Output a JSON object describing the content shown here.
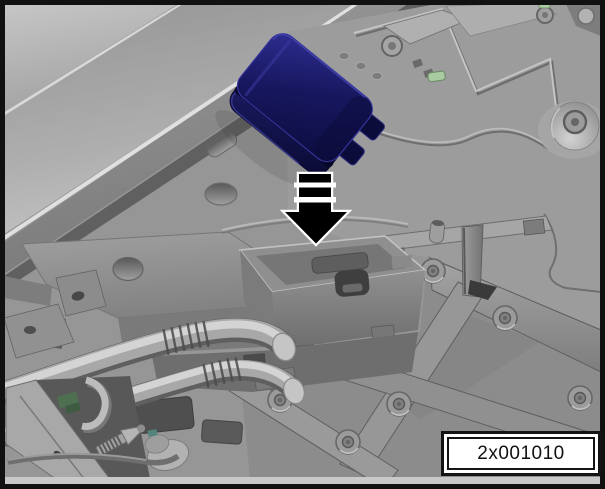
{
  "figure": {
    "type": "technical-illustration",
    "image_code": "2x001010",
    "arrow_direction": "down"
  },
  "label_box": {
    "text": "2x001010"
  },
  "colors": {
    "frame_border": "#111111",
    "background_gray": "#969696",
    "module_navy": "#16165e",
    "module_navy_light": "#2d2d90",
    "module_navy_dark": "#0c0c3a",
    "arrow_fill": "#000000",
    "arrow_outline": "#ffffff",
    "clip_green": "#a9cba2",
    "label_background": "#ffffff",
    "label_text": "#111111"
  }
}
